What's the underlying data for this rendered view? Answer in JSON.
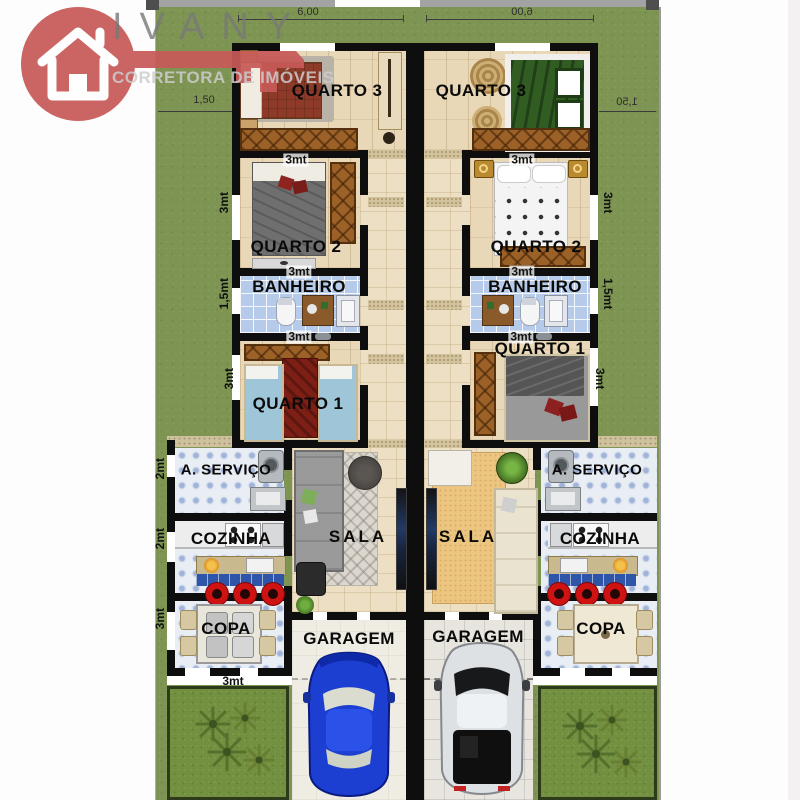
{
  "meta": {
    "kind": "floor-plan",
    "description": "Mirrored duplex house floor plan"
  },
  "logo": {
    "brand": "IVANY",
    "tagline": "CORRETORA DE IMÓVEIS"
  },
  "rooms": {
    "quarto3": "QUARTO 3",
    "quarto2": "QUARTO 2",
    "banheiro": "BANHEIRO",
    "quarto1": "QUARTO 1",
    "servico": "A. SERVIÇO",
    "cozinha": "COZINHA",
    "sala": "SALA",
    "copa": "COPA",
    "garagem": "GARAGEM"
  },
  "dims": {
    "front_width": "6,00",
    "side_setback": "1,50",
    "three_m": "3mt",
    "one_half_m": "1,5mt",
    "two_m": "2mt"
  },
  "colors": {
    "grass": "#7d9452",
    "wall": "#0e0e0e",
    "bath_tile": "#b6cbe9",
    "service_tile": "#e9edf4",
    "wood_floor": "#e9d8b8",
    "logo_red": "#c75a58",
    "car_left": "#1c3fd2",
    "car_right": "#dde1e4"
  }
}
